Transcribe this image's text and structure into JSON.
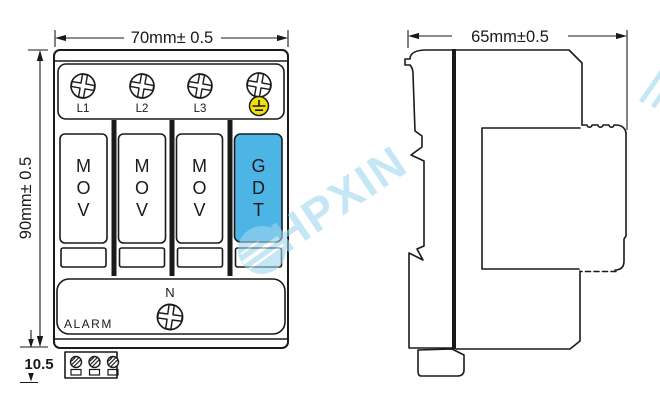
{
  "colors": {
    "line": "#1a1a1a",
    "gdt_fill": "#4cb5e6",
    "ground_fill": "#f2e10a",
    "watermark": "#9ed6ef"
  },
  "front_view": {
    "width_dimension": "70mm± 0.5",
    "height_dimension": "90mm± 0.5",
    "bottom_dimension": "10.5",
    "terminal_labels": [
      "L1",
      "L2",
      "L3"
    ],
    "modules": [
      {
        "lines": [
          "M",
          "O",
          "V"
        ]
      },
      {
        "lines": [
          "M",
          "O",
          "V"
        ]
      },
      {
        "lines": [
          "M",
          "O",
          "V"
        ]
      },
      {
        "lines": [
          "G",
          "D",
          "T"
        ]
      }
    ],
    "neutral_label": "N",
    "alarm_label": "ALARM"
  },
  "side_view": {
    "width_dimension": "65mm±0.5"
  },
  "watermark": {
    "text": "HPXIN"
  }
}
